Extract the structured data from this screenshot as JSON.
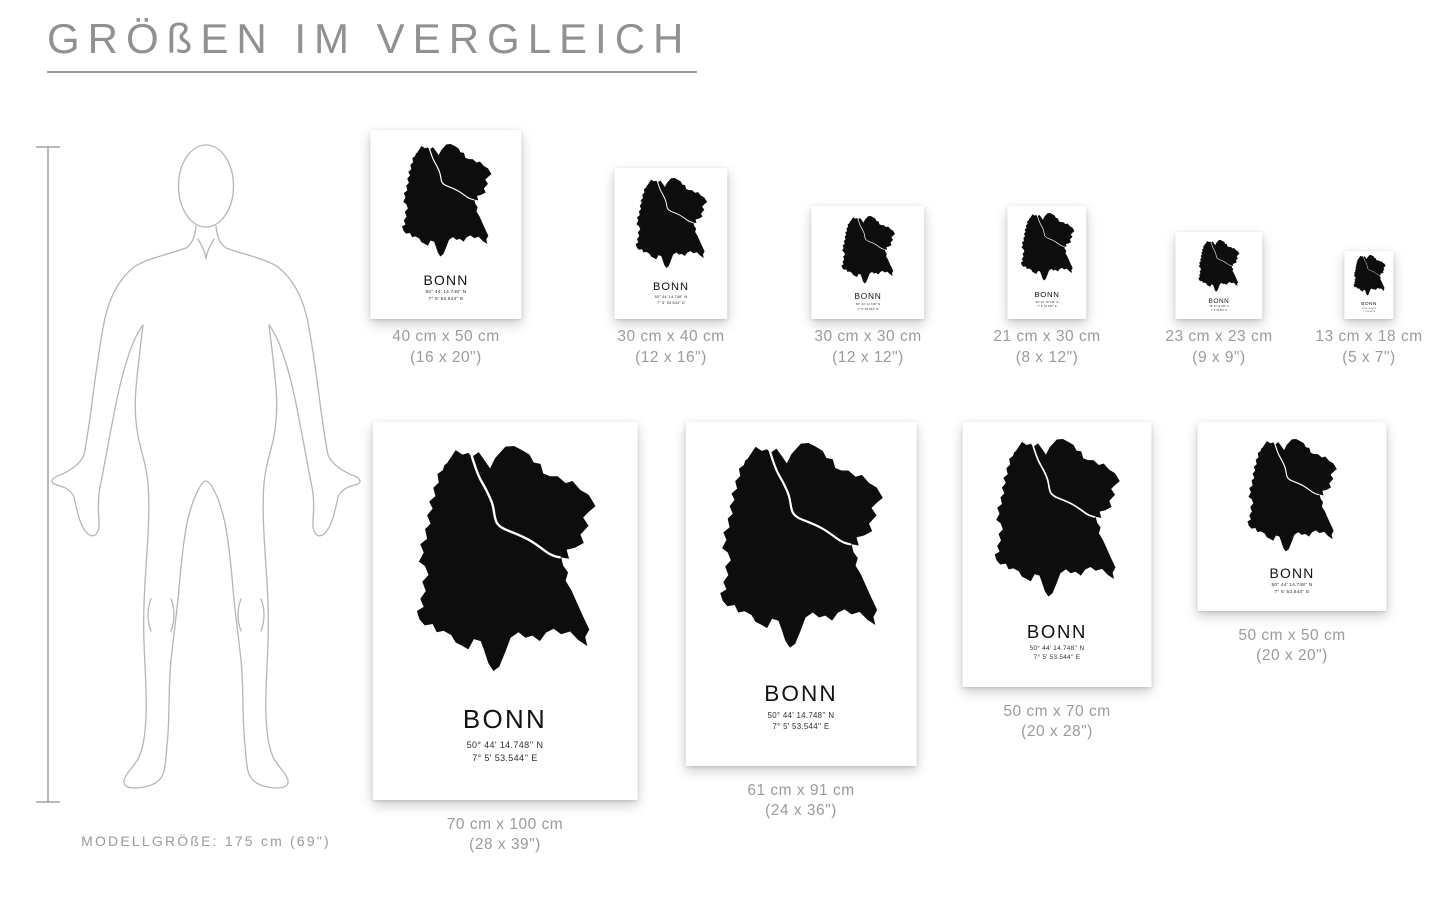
{
  "title": "GRÖßEN IM VERGLEICH",
  "model": {
    "label": "MODELLGRÖßE: 175 cm (69\")"
  },
  "poster": {
    "city": "BONN",
    "coord_line1": "50° 44' 14.748'' N",
    "coord_line2": "7° 5' 53.544'' E"
  },
  "rows": {
    "row1": [
      {
        "cm": "40 cm x 50 cm",
        "in": "(16 x 20\")",
        "w": 40,
        "h": 50
      },
      {
        "cm": "30 cm x 40 cm",
        "in": "(12 x 16\")",
        "w": 30,
        "h": 40
      },
      {
        "cm": "30 cm x 30 cm",
        "in": "(12 x 12\")",
        "w": 30,
        "h": 30
      },
      {
        "cm": "21 cm x 30 cm",
        "in": "(8 x 12\")",
        "w": 21,
        "h": 30
      },
      {
        "cm": "23 cm x 23 cm",
        "in": "(9 x 9\")",
        "w": 23,
        "h": 23
      },
      {
        "cm": "13 cm x 18 cm",
        "in": "(5 x 7\")",
        "w": 13,
        "h": 18
      }
    ],
    "row2": [
      {
        "cm": "70 cm x 100 cm",
        "in": "(28 x 39\")",
        "w": 70,
        "h": 100
      },
      {
        "cm": "61 cm x 91 cm",
        "in": "(24 x 36\")",
        "w": 61,
        "h": 91
      },
      {
        "cm": "50 cm x 70 cm",
        "in": "(20 x 28\")",
        "w": 50,
        "h": 70
      },
      {
        "cm": "50 cm x 50 cm",
        "in": "(20 x 20\")",
        "w": 50,
        "h": 50
      }
    ]
  },
  "colors": {
    "map_black": "#0d0d0d",
    "river_white": "#ffffff",
    "label_gray": "#9b9b9b",
    "title_gray": "#8f9193",
    "figure_gray": "#b6b6b6"
  }
}
